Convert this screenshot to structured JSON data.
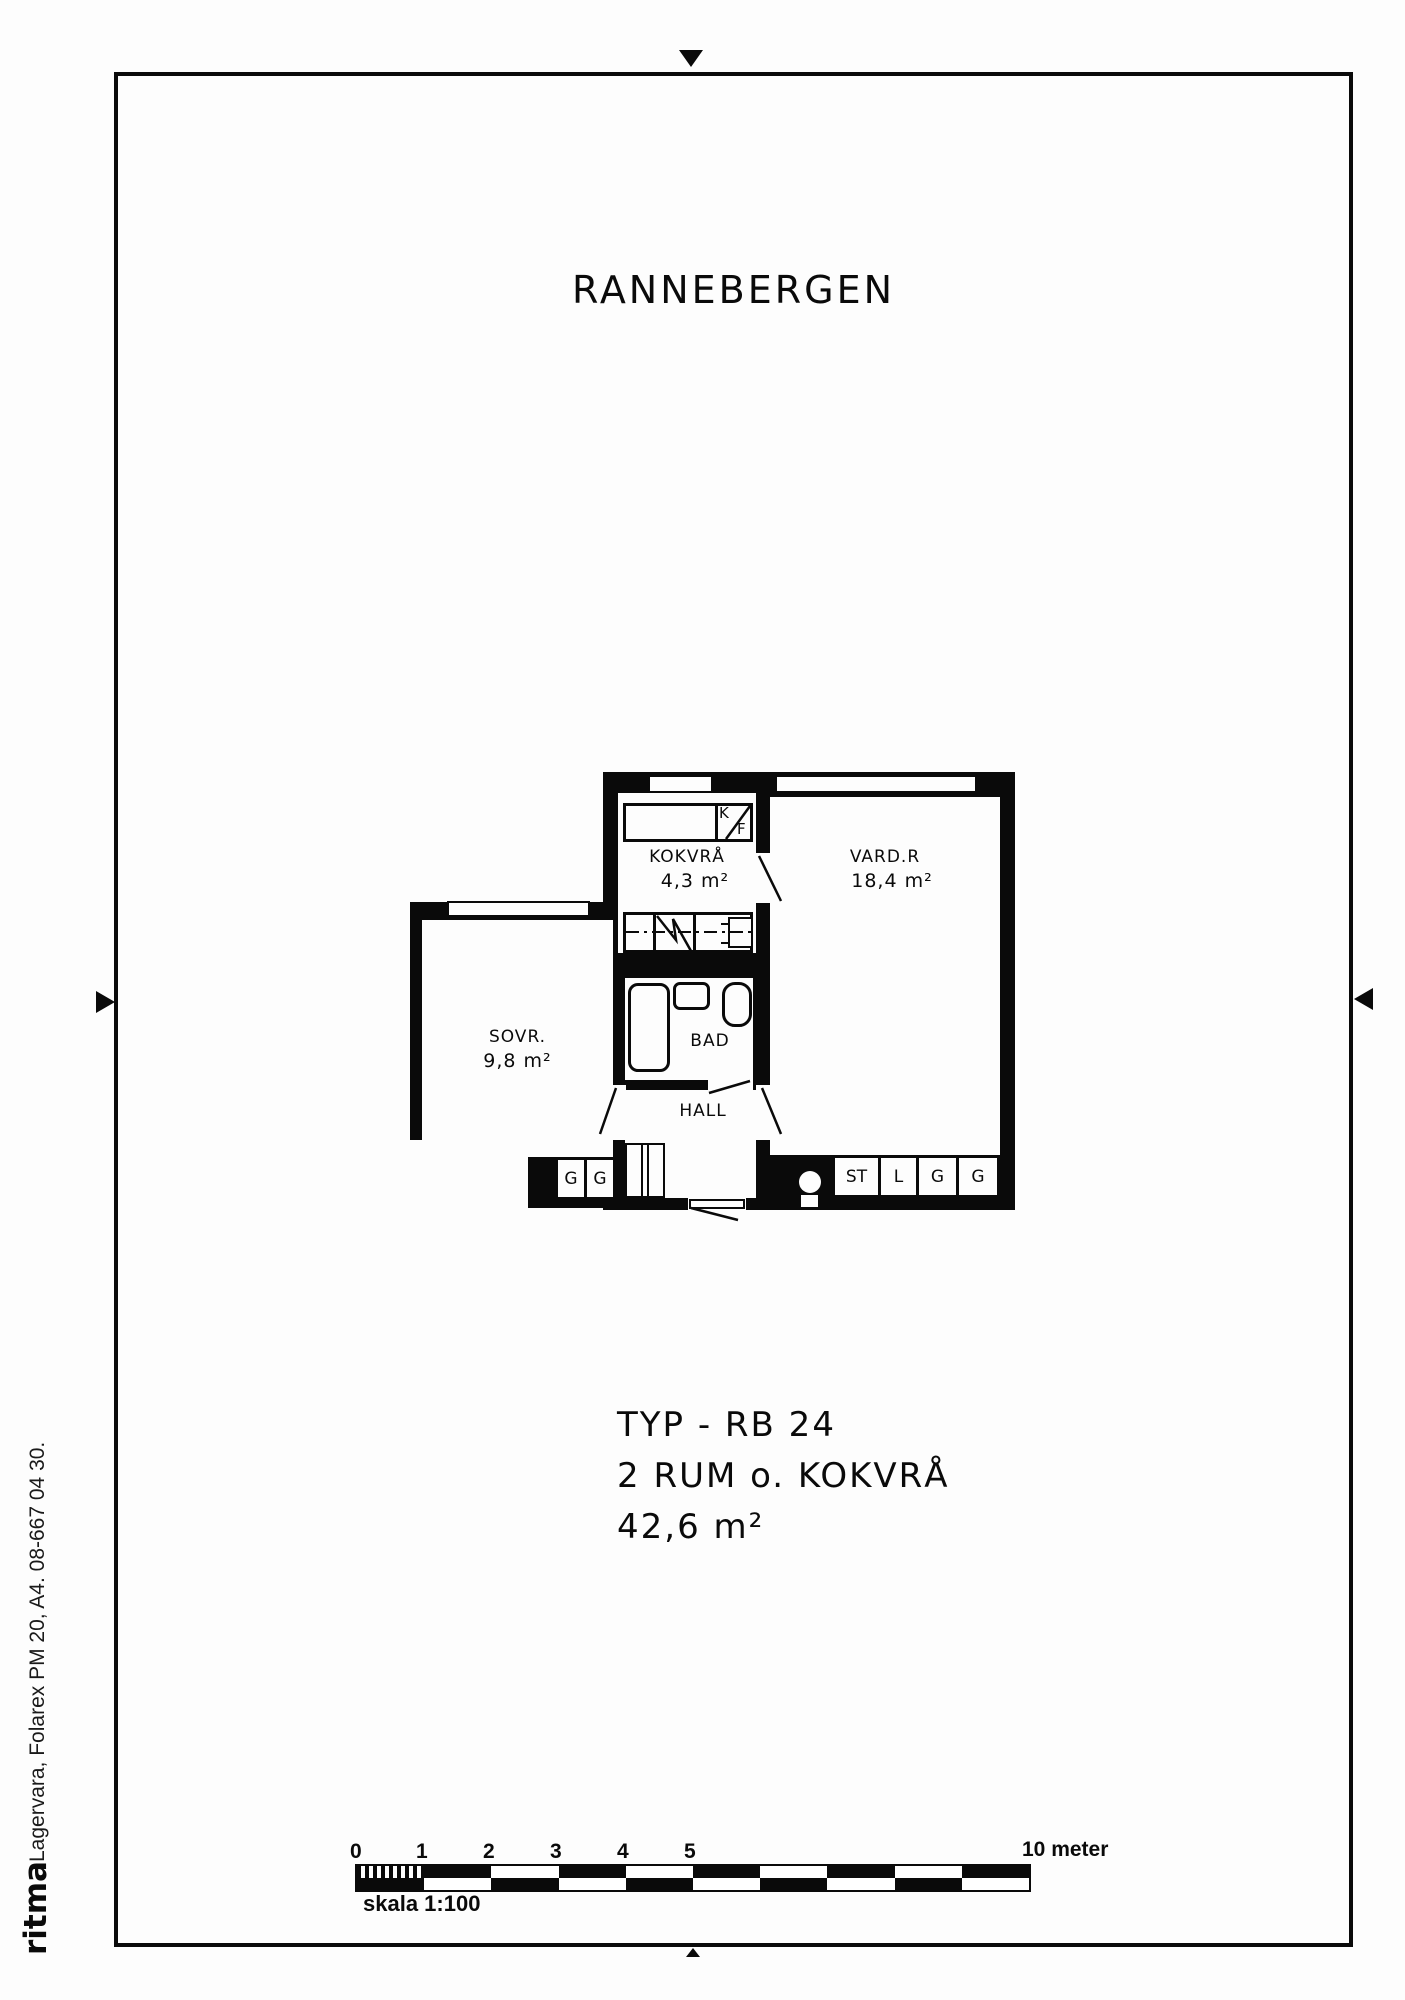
{
  "page": {
    "title": "RANNEBERGEN"
  },
  "plan": {
    "rooms": [
      {
        "id": "kokvra",
        "label": "KOKVRÅ",
        "area": "4,3 m²"
      },
      {
        "id": "vardagsrum",
        "label": "VARD.R",
        "area": "18,4 m²"
      },
      {
        "id": "sovrum",
        "label": "SOVR.",
        "area": "9,8 m²"
      },
      {
        "id": "bad",
        "label": "BAD"
      },
      {
        "id": "hall",
        "label": "HALL"
      }
    ],
    "appliance": {
      "k": "K",
      "f": "F"
    },
    "closets": {
      "left": [
        "G",
        "G"
      ],
      "right": [
        "ST",
        "L",
        "G",
        "G"
      ]
    }
  },
  "type_block": {
    "line1": "TYP - RB 24",
    "line2": "2 RUM o. KOKVRÅ",
    "line3": "42,6 m²"
  },
  "scale_bar": {
    "ticks": [
      "0",
      "1",
      "2",
      "3",
      "4",
      "5"
    ],
    "right_label": "10 meter",
    "caption": "skala 1:100"
  },
  "margin": {
    "vertical_text": "Lagervara, Folarex PM 20, A4. 08-667 04 30.",
    "logo": "ritma"
  },
  "colors": {
    "ink": "#0a0a0a",
    "paper": "#fdfdfd"
  }
}
